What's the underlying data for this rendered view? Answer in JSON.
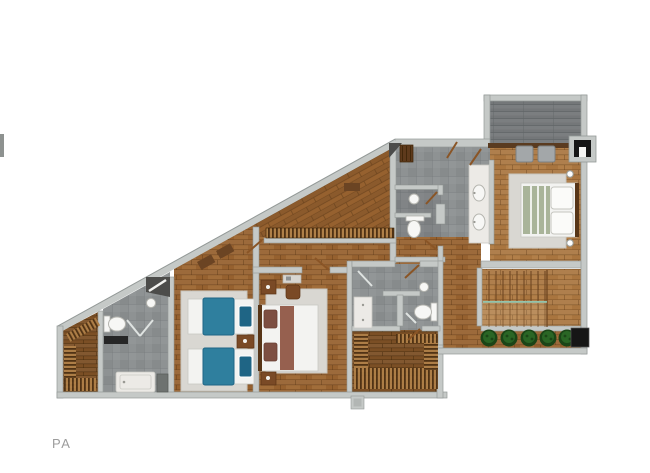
{
  "page": {
    "type": "architectural floor plan render, top-down",
    "label": "PA"
  },
  "colors": {
    "label": "#9c9c9c",
    "wall": "#c5c9c7",
    "wallEdge": "#939997",
    "woodBase": "#96612f",
    "woodLight": "#a9753f",
    "woodJoint": "#5e3a17",
    "closetWood": "#7b4f25",
    "slatDark": "#4e3114",
    "slatLight": "#b08048",
    "tile": "#8e9293",
    "tileLine": "#6f7476",
    "terrace": "#747779",
    "terraceLine": "#5f6365",
    "rug": "#d9d7d2",
    "rugEdge": "#c6c4be",
    "white": "#f3f3f1",
    "fixture": "#f7f7f5",
    "fixtureStroke": "#b5b5af",
    "duvetBlue": "#2f7f9e",
    "duvetBlueDark": "#1f6585",
    "bedGreen": "#a9b499",
    "pillowBrown": "#7d4f42",
    "runnerBrown": "#96604f",
    "headboard": "#573517",
    "nightstand": "#7a4a26",
    "doorBrown": "#8a5526",
    "darkWedge": "#4c4c4a",
    "plant": "#2a6625",
    "plantDark": "#1b4517",
    "black": "#161616",
    "teal": "#8fd0bd",
    "stub": "#8e9290"
  }
}
